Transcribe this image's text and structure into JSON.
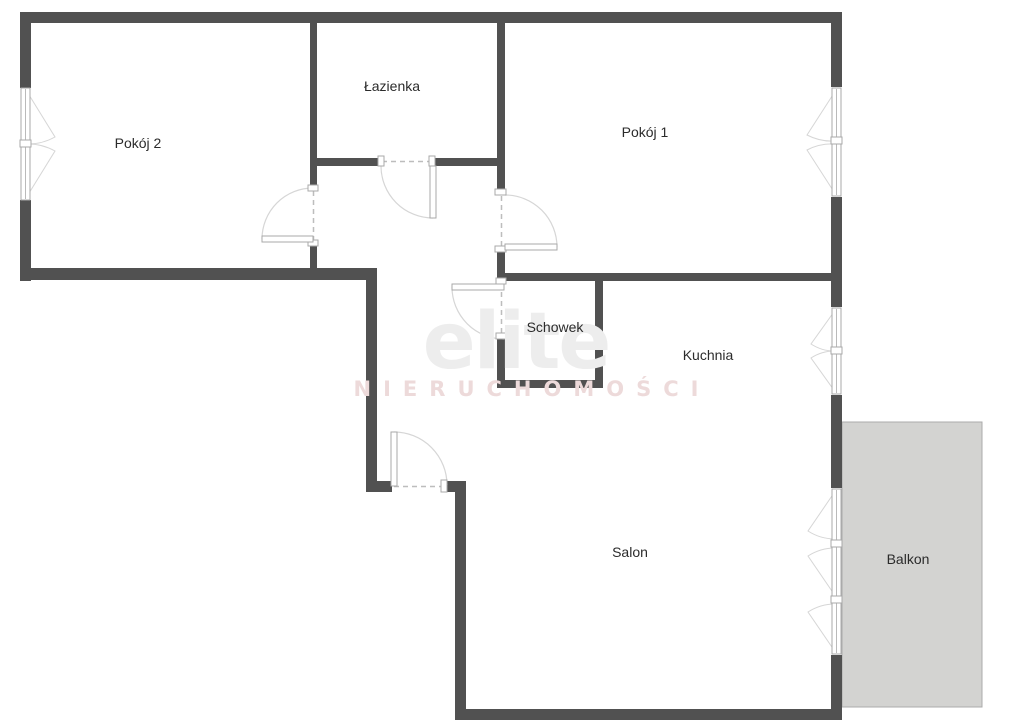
{
  "plan": {
    "rooms": [
      {
        "key": "pokoj2",
        "name": "Pokój 2"
      },
      {
        "key": "lazienka",
        "name": "Łazienka"
      },
      {
        "key": "pokoj1",
        "name": "Pokój 1"
      },
      {
        "key": "schowek",
        "name": "Schowek"
      },
      {
        "key": "kuchnia",
        "name": "Kuchnia"
      },
      {
        "key": "salon",
        "name": "Salon"
      },
      {
        "key": "balkon",
        "name": "Balkon"
      }
    ]
  },
  "watermark": {
    "brand": "elite",
    "subtitle": "NIERUCHOMOŚCI"
  },
  "colors": {
    "background": "#ffffff",
    "wall": "#515151",
    "balcony_fill": "#d3d3d1",
    "balcony_border": "#ababab",
    "label_text": "#2b2b2b",
    "door_line": "#a9a9a9",
    "arc_line": "#d6d6d6",
    "dash_line": "#bdbdbd",
    "watermark_brand": "#ededed",
    "watermark_subtitle": "#eddada"
  }
}
